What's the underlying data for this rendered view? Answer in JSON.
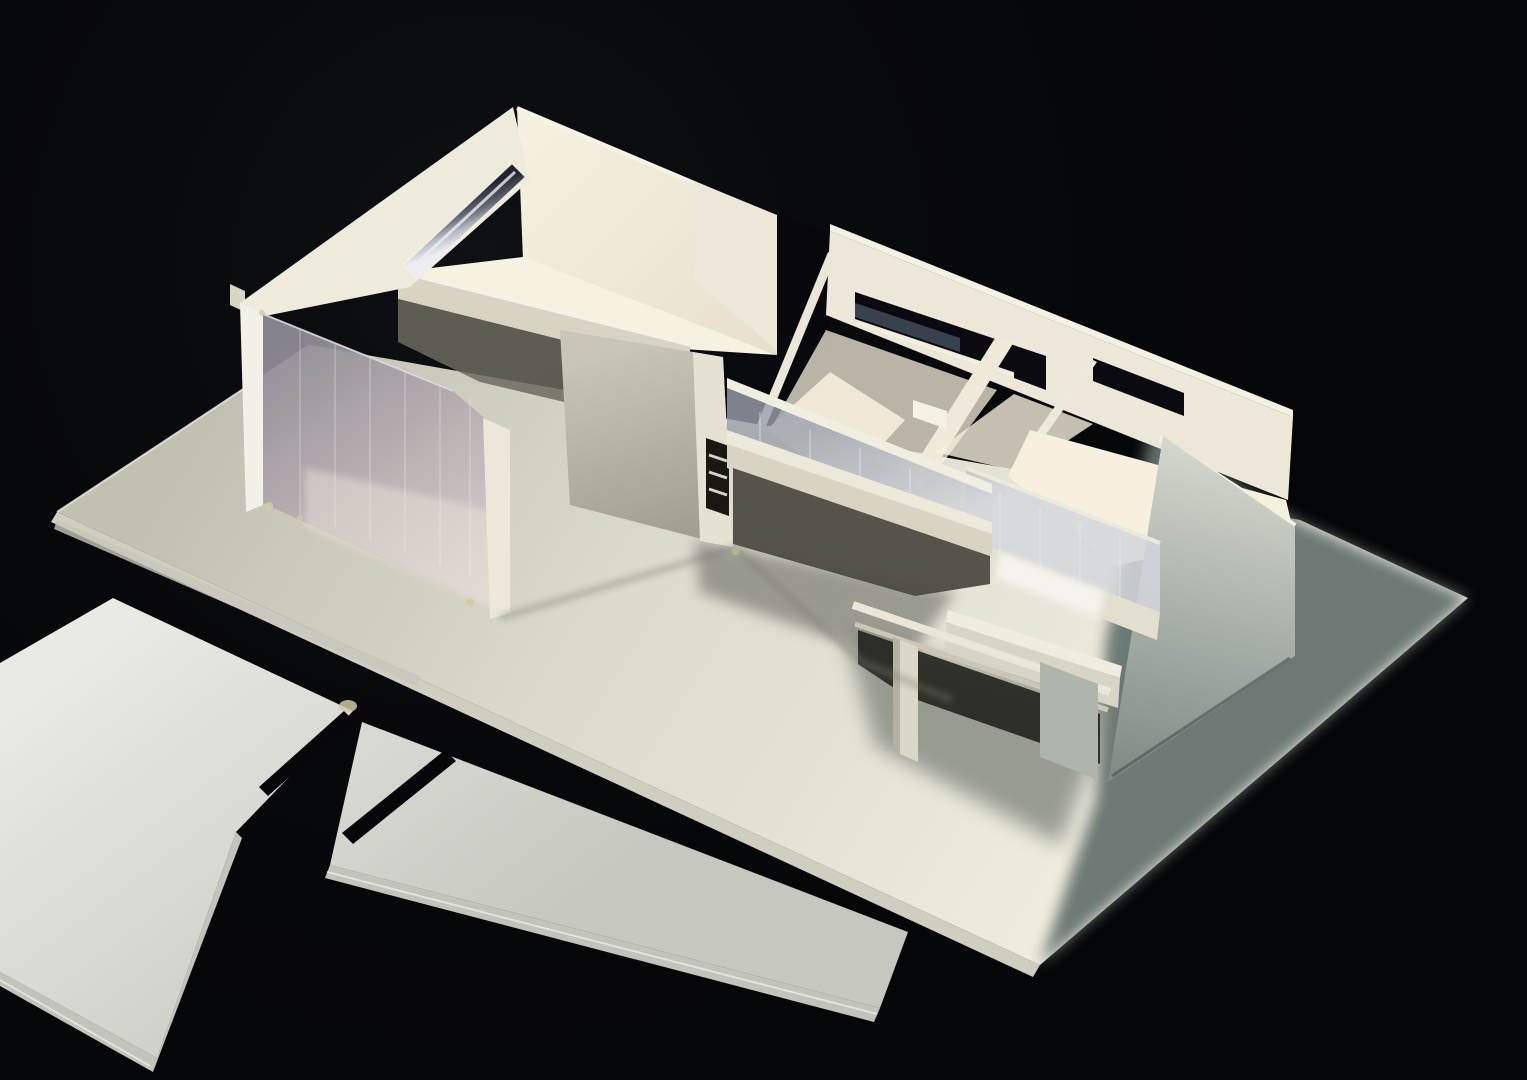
{
  "meta": {
    "domain": "photograph",
    "subject": "Studio photograph of a white cardboard architectural study model of a flat-roofed modernist house, lit from the upper right against a black background, with two loose slotted wall panels lying beside the baseboard",
    "visible_text": "none"
  },
  "scene": {
    "background": {
      "description": "black velvet studio backdrop",
      "color_key": "bg"
    },
    "objects": [
      {
        "name": "baseboard",
        "description": "large rectangular museum-board base seen in perspective, bright at front, falling into deep shadow on the right side"
      },
      {
        "name": "house-model",
        "description": "single-storey open-top house model: left double-height room with clerestory slot window and full-height acetate glazing, central corridor with ribbon windows and entry void, bridge parapet with acetate strip, right open room with tall side wall, sunken terrace with clear acetate railing, cantilevered balcony on a small pier"
      },
      {
        "name": "clerestory-window",
        "description": "narrow strip window with silver acetate glazing in the high left wall"
      },
      {
        "name": "acetate-glazing",
        "description": "transparent plastic sheet facade of the left room showing interior reflections"
      },
      {
        "name": "loose-panel-large",
        "description": "flat cut wall panel with one slit, lying on the backdrop lower left"
      },
      {
        "name": "loose-panel-strip",
        "description": "long flat wall strip with one slit, lying diagonally below the base"
      },
      {
        "name": "cast-shadows",
        "description": "soft shadows thrown across the right of the baseboard and under balcony and porch"
      }
    ]
  },
  "palette": {
    "bg": "#050608",
    "vig": "#1a1c22",
    "baseA": "#c1c0b3",
    "baseB": "#dcdacd",
    "baseC": "#eeecdf",
    "baseEdge": "#cfcec1",
    "baseEdgeHi": "#f0eee3",
    "baseLayer": "#c8c7ba",
    "shadowCool": "#66736f",
    "shadowSoft": "#767b72",
    "shadowPorch": "#6b6c63",
    "pieceA0": "#e9eae4",
    "pieceA1": "#c6c8c0",
    "pieceEdge": "#c2c4bc",
    "pieceEdgeHi": "#eff1ea",
    "slit": "#07070b",
    "glue": "#cfc8a2",
    "glue2": "#d6cba0",
    "cardLit": "#ece7d8",
    "fascia": "#eeebdd",
    "wallEdgeLit": "#f3f1e7",
    "cardTopEdge": "#f3f0e4",
    "cardMid": "#d8d3c3",
    "cardShade": "#b5b1a2",
    "interior0": "#f6f1e1",
    "interior1": "#e6dfcc",
    "floorWarm": "#f7f0df",
    "floorWash": "#f5eedb",
    "underSlab": "#6e6a60",
    "shade0": "#c9c5b8",
    "shade1": "#a09c90",
    "rwall0": "#d7dad0",
    "rwall1": "#aab2aa",
    "rwall2": "#808c85",
    "acet0": "#8f8c96",
    "acet1": "#b4aaae",
    "acet2": "#d9d4d0",
    "acetTop": "#d6dade",
    "glass0": "#9aa0ab",
    "glass1": "#d3d6dc",
    "streak": "#f0f2f4",
    "silver0": "#21242d",
    "silver1": "#5f6571",
    "silver2": "#b5bac4",
    "silver3": "#eceef2",
    "openDark": "#0a0a10",
    "gapDark": "#07070c",
    "sheenBlue": "#414b5c",
    "voidWarm": "#4e4b42",
    "voidDark": "#24231f",
    "railLit": "#f0ede1",
    "beamTop": "#ece8da",
    "pillar": "#e6e2d3",
    "pillarWin": "#191813",
    "ladder": "#d8d3c5",
    "parapetFace": "#d9d5c6",
    "parapetTop": "#f0ede0",
    "midBand": "#e3dfd0",
    "pier": "#dbd7c8",
    "pierShade": "#b5b1a2",
    "rsupport": "#aeb5ac",
    "reflect": "#f6f6f2",
    "nub": "#f4f1e5",
    "contact": "#7c7a6f",
    "sill": "#f2eee1",
    "glow": "#e9e2d7",
    "sliver": "#d8d4c6",
    "p2face": "#efe9d9",
    "p1edge": "#eae6d8",
    "p3edge": "#ece8da",
    "rimNE": "#f5f2e6",
    "railTop": "#eceadf"
  }
}
